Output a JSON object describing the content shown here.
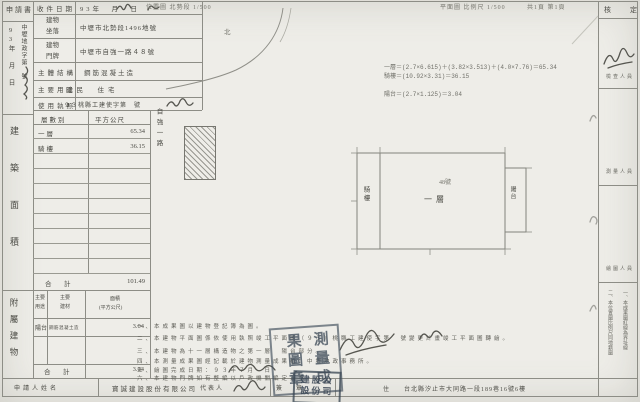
{
  "colors": {
    "paper": "#eeede8",
    "line": "#8d8d86",
    "ink": "#4b4b45",
    "stamp": "#46525f"
  },
  "top": {
    "left_scale": "位置圖 北勢段 1/500",
    "north_mark": "北",
    "right_scale": "平面圖 比例尺 1/500",
    "pages": "共1頁 第1頁"
  },
  "left_strip": {
    "application": "申請書",
    "date_vertical": "93年　月　日",
    "doc_no_vertical": "中壢地政字第　號",
    "area_label": "建築面積",
    "annex_label": "附屬建物"
  },
  "form": {
    "rows": [
      {
        "label": "收件日期",
        "value": "93年　月　日"
      },
      {
        "label": "建物坐落",
        "value": "中壢市北勢段1496地號"
      },
      {
        "label": "建物門牌",
        "value": "中壢市自強一路４８號"
      },
      {
        "label": "主體結構",
        "value": "鋼筋混凝土造"
      },
      {
        "label": "主要用途",
        "value": "國民　住宅"
      },
      {
        "label": "使用執照",
        "value": "９３桃縣工建使字第　號"
      }
    ]
  },
  "area_table": {
    "headers": [
      "層數別",
      "平方公尺"
    ],
    "rows": [
      {
        "floor": "一層",
        "area": "65.34"
      },
      {
        "floor": "騎樓",
        "area": "36.15"
      }
    ],
    "total_label": "合　計",
    "total": "101.49"
  },
  "annex_table": {
    "headers": [
      "主要用途",
      "主要建材"
    ],
    "area_header": [
      "面積",
      "(平方公尺)"
    ],
    "rows": [
      {
        "use": "陽台",
        "material": "鋼筋混凝土造",
        "area": "3.04"
      }
    ],
    "total_label": "合　計",
    "total": "3.04"
  },
  "map": {
    "road_label": "自強一路",
    "formulas": [
      "一層＝(2.7×6.615)＋(3.82×3.513)＋(4.0×7.76)＝65.34",
      "騎樓＝(10.92×3.31)＝36.15",
      "陽台＝(2.7×1.125)＝3.04"
    ],
    "plan": {
      "left": "騎樓",
      "center": "一層",
      "right": "陽台",
      "mark": "48號"
    }
  },
  "right_panel": {
    "approve": "核　定",
    "sections": [
      "檢查人員",
      "測量人員",
      "繪圖人員"
    ],
    "notes": [
      "一、本成果圖紅線為界址線",
      "二、本位置圖比例尺同地籍圖"
    ]
  },
  "notes": {
    "items": [
      "一、本成果圖以建物登記簿為圖。",
      "二、本建物平面圖係依使用執照竣工平面圖（９３）桃縣工建使字第　號變更計畫竣工平面圖轉繪。",
      "三、本建物為十一層構造物之第一層　陽台部分。",
      "四、本測量成果圖經記載於建物測量成果檔：中壢地政事務所。",
      "五、繪圖完成日期：９３年７月　日",
      "六、本建物門牌如有整編以戶政機關編定為準。"
    ]
  },
  "footer": {
    "applicant_label": "申請人姓名",
    "applicant": "寶誠建設股份有限公司",
    "rep_label": "代表人",
    "sign_label": "簽　章",
    "addr_label": "住",
    "address": "台北縣汐止市大同路一段189巷16號6樓"
  },
  "stamps": {
    "office_seal_right": "測量成",
    "office_seal_left": "果圖章",
    "company_seal_row1": "建股公",
    "company_seal_row2": "設份司"
  }
}
